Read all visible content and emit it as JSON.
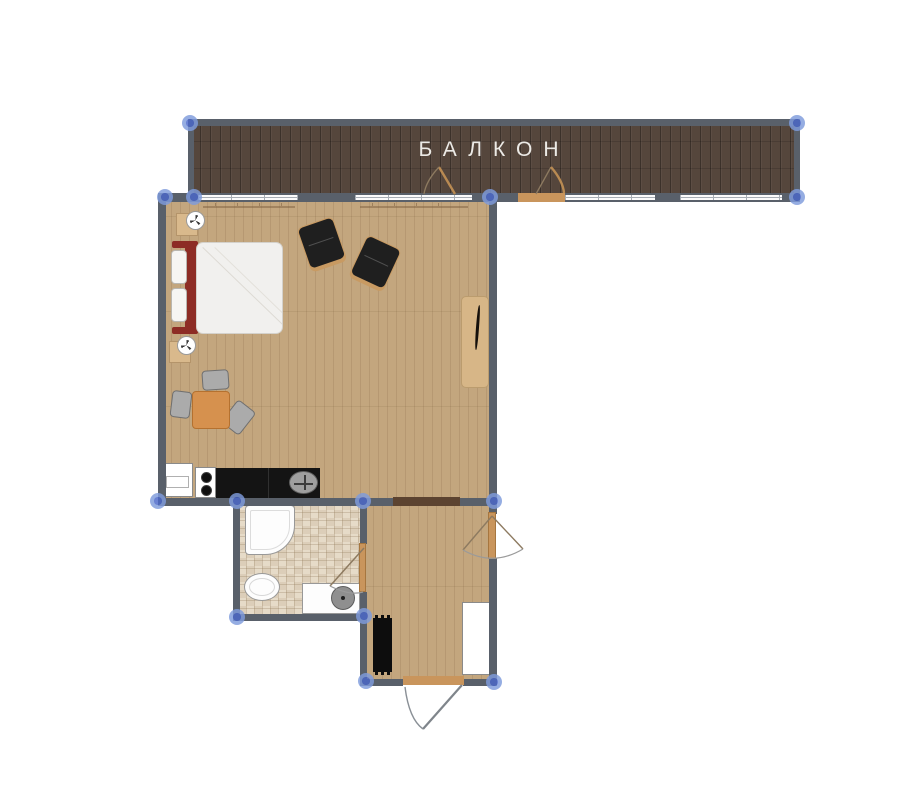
{
  "plan": {
    "balcony_label": "БАЛКОН"
  },
  "colors": {
    "wall": "#59606a",
    "window_fill": "#fbfbfc",
    "window_line": "#a7adb5",
    "marker_halo": "#7e9bdc",
    "marker_core": "#4a67c9",
    "balcony_floor": "#55463c",
    "room_floor": "#c3a67e",
    "tile_floor": "#e6dbc8",
    "door_wood": "#c9955c",
    "threshold_dark": "#5c4330",
    "table_orange": "#d6914e",
    "bed_red": "#8d2c25",
    "counter_black": "#141414",
    "chair_gray": "#ababab",
    "armchair_black": "#1f1f1f",
    "desk_tan": "#d7b687",
    "label_color": "#eceae6"
  }
}
